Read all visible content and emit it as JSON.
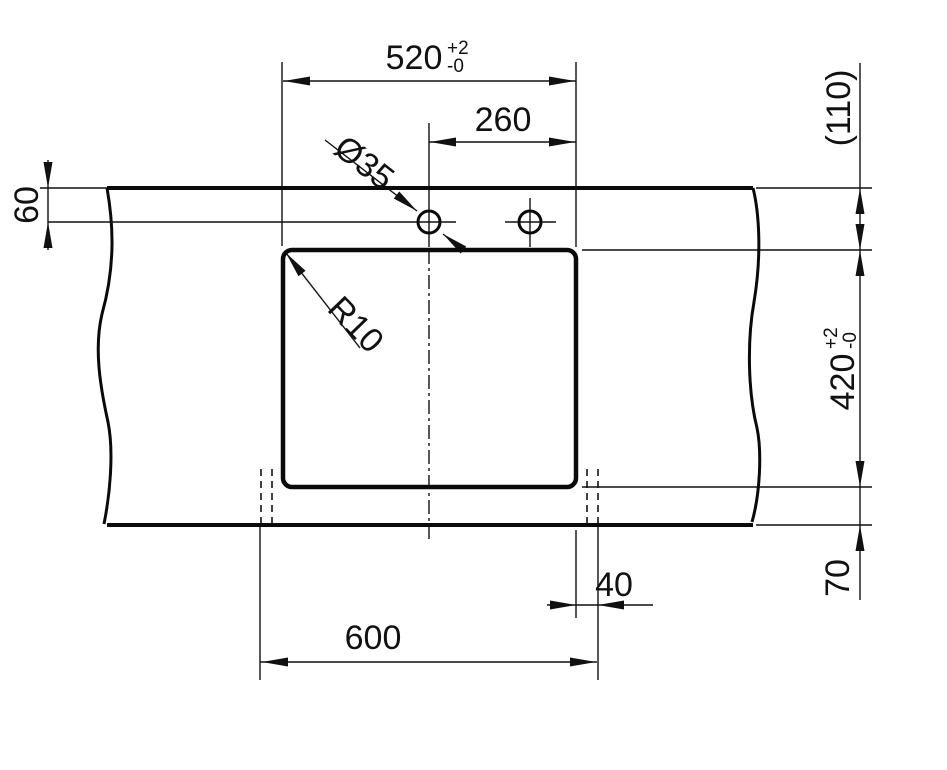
{
  "labels": {
    "cutout_width": "520",
    "cutout_width_tol_plus": "+2",
    "cutout_width_tol_minus": "-0",
    "hole_spacing": "260",
    "hole_diameter": "Ø35",
    "corner_radius": "R10",
    "edge_to_hole_centers": "60",
    "rear_overhang_ref": "(110)",
    "cutout_height": "420",
    "cutout_height_tol_plus": "+2",
    "cutout_height_tol_minus": "-0",
    "front_overhang": "70",
    "side_offset": "40",
    "overall_width": "600"
  },
  "colors": {
    "line": "#000000",
    "background": "#ffffff"
  }
}
